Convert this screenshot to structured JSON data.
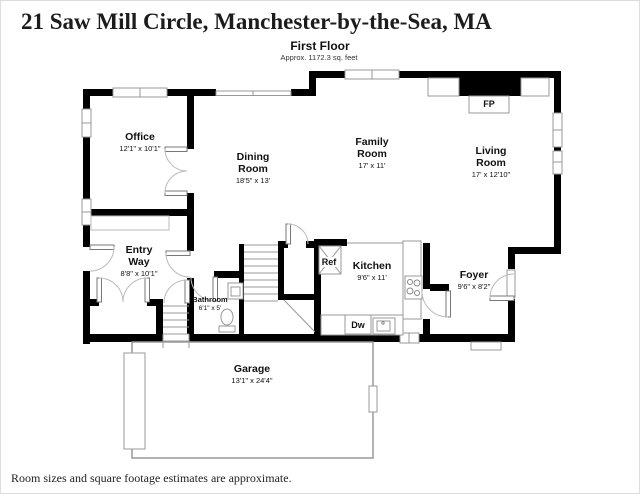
{
  "title": "21 Saw Mill Circle, Manchester-by-the-Sea, MA",
  "floor": {
    "name": "First Floor",
    "area_note": "Approx. 1172.3 sq. feet"
  },
  "footer": "Room sizes and square footage estimates are approximate.",
  "rooms": {
    "office": {
      "name": "Office",
      "dims": "12'1\" x 10'1\""
    },
    "dining_room": {
      "name": "Dining Room",
      "dims": "18'5\" x 13'"
    },
    "family_room": {
      "name": "Family Room",
      "dims": "17' x 11'"
    },
    "living_room": {
      "name": "Living Room",
      "dims": "17' x 12'10\""
    },
    "entry_way": {
      "name": "Entry Way",
      "dims": "8'8\" x 10'1\""
    },
    "bathroom": {
      "name": "Bathroom",
      "dims": "6'1\" x 5'"
    },
    "kitchen": {
      "name": "Kitchen",
      "dims": "9'6\" x 11'"
    },
    "foyer": {
      "name": "Foyer",
      "dims": "9'6\" x 8'2\""
    },
    "garage": {
      "name": "Garage",
      "dims": "13'1\" x 24'4\""
    }
  },
  "fixtures": {
    "fireplace": "FP",
    "refrigerator": "Ref",
    "dishwasher": "Dw"
  },
  "colors": {
    "wall": "#000000",
    "fixture_line": "#999999",
    "text": "#111111"
  }
}
